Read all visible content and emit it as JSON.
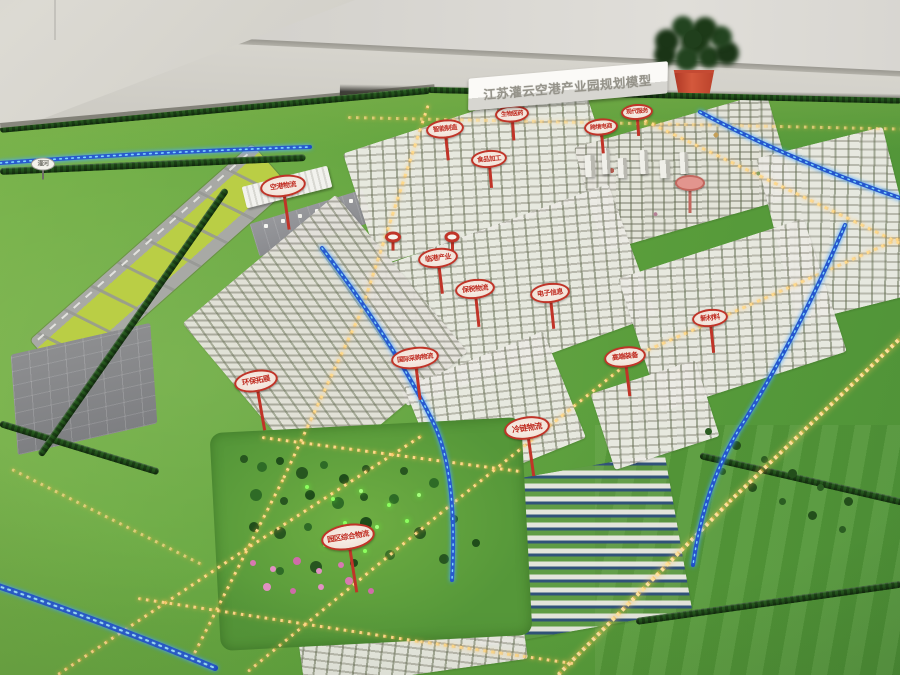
{
  "scene": "showroom photograph of a physical urban-planning scale model (sand table) of an airport industrial park",
  "title_sign": {
    "text": "江苏灌云空港产业园规划模型"
  },
  "signs": [
    {
      "label": "空港物流"
    },
    {
      "label": "智能制造"
    },
    {
      "label": "食品加工"
    },
    {
      "label": "生物医药"
    },
    {
      "label": "跨境电商"
    },
    {
      "label": "现代服务"
    },
    {
      "label": "临港产业"
    },
    {
      "label": "保税物流"
    },
    {
      "label": "电子信息"
    },
    {
      "label": "国际采购物流"
    },
    {
      "label": "冷链物流"
    },
    {
      "label": "环保拓展"
    },
    {
      "label": "园区综合物流"
    },
    {
      "label": "高端装备"
    },
    {
      "label": "新材料"
    }
  ],
  "river_sign": {
    "label": "灌河"
  },
  "colors": {
    "sign_red": "#c03428",
    "led_amber": "#ffd98a",
    "water_blue": "#1a49c9",
    "water_glow": "#7fd9ff",
    "grass_green": "#5fa23d",
    "runway_infield": "#bace45",
    "wall_gray": "#d6d4cf"
  }
}
